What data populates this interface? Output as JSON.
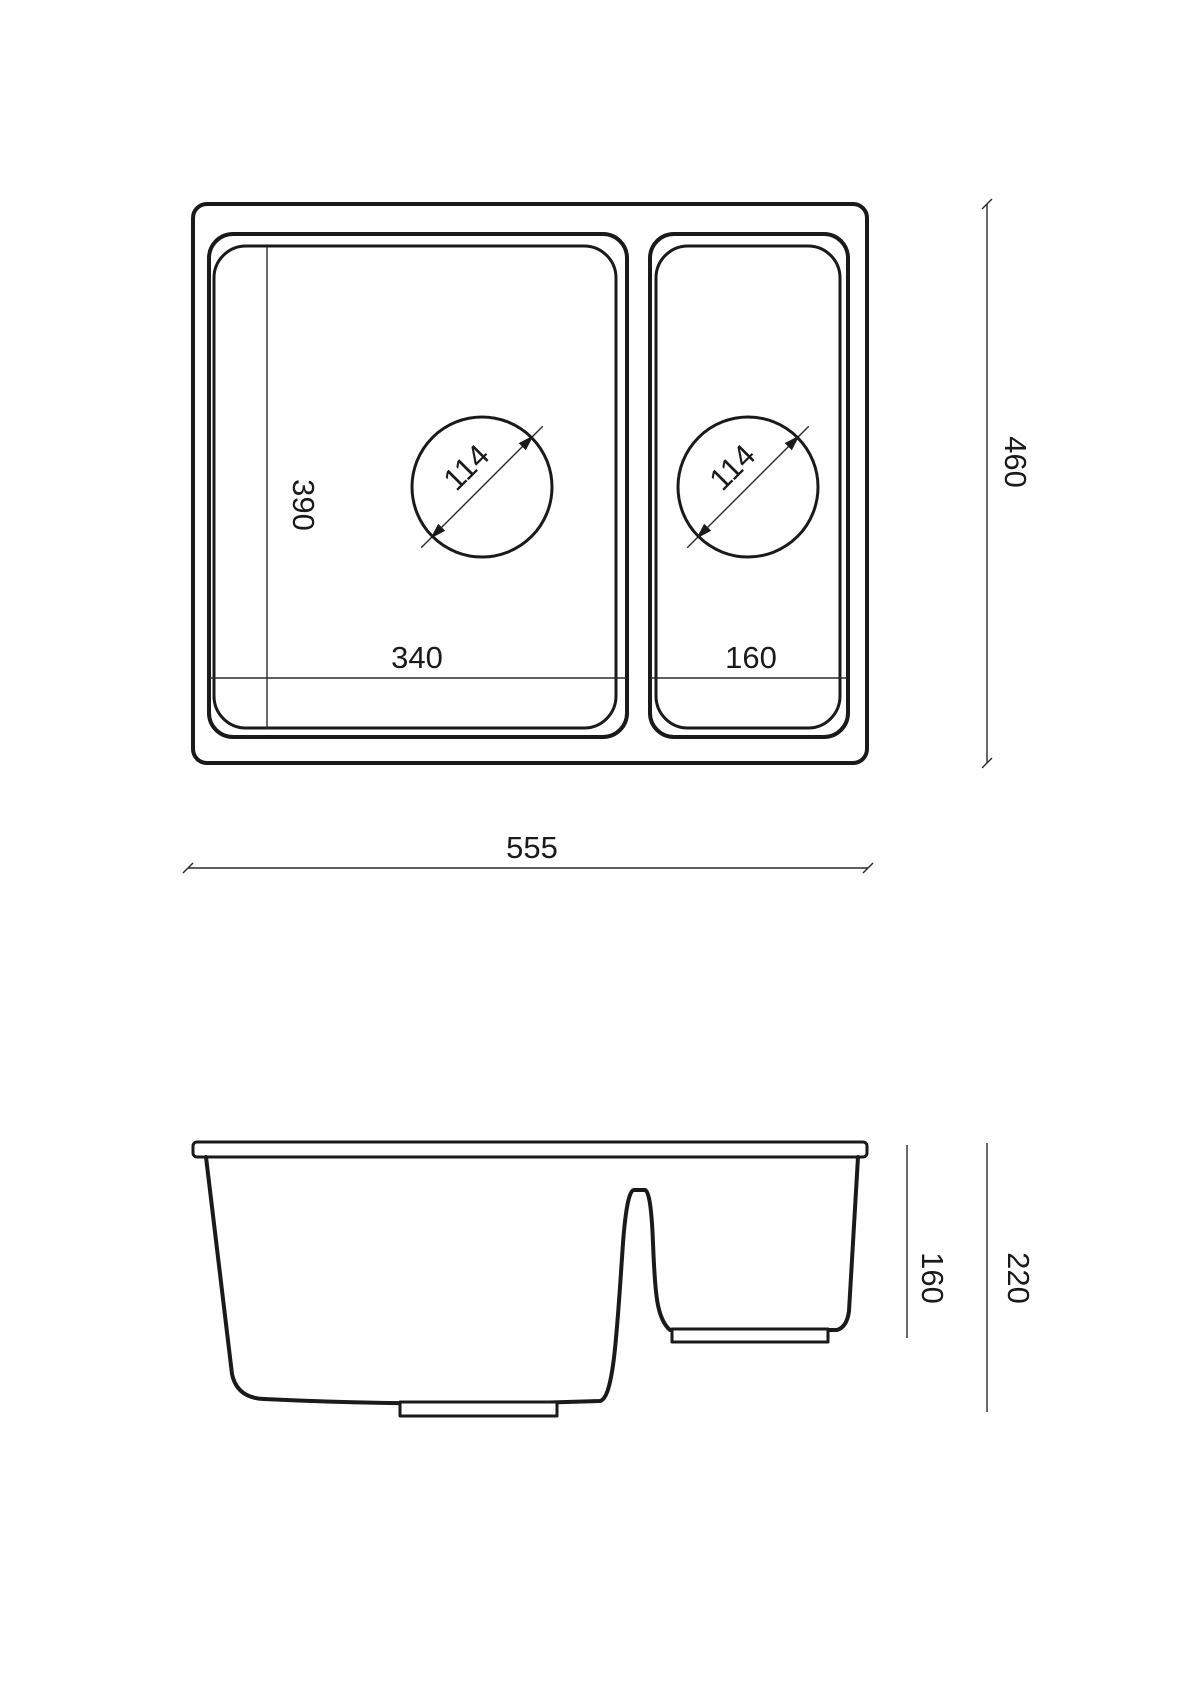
{
  "drawing": {
    "kind": "sink-technical-drawing",
    "views": {
      "top": {
        "label": "top-view",
        "dims": {
          "overall_width": "555",
          "overall_depth": "460",
          "left_bowl_width": "340",
          "left_bowl_depth": "390",
          "right_bowl_width": "160",
          "left_drain_diameter": "114",
          "right_drain_diameter": "114"
        }
      },
      "side": {
        "label": "side-view",
        "dims": {
          "small_bowl_depth": "160",
          "overall_height": "220"
        }
      }
    },
    "colors": {
      "line": "#1a1a1a",
      "background": "#ffffff"
    }
  }
}
